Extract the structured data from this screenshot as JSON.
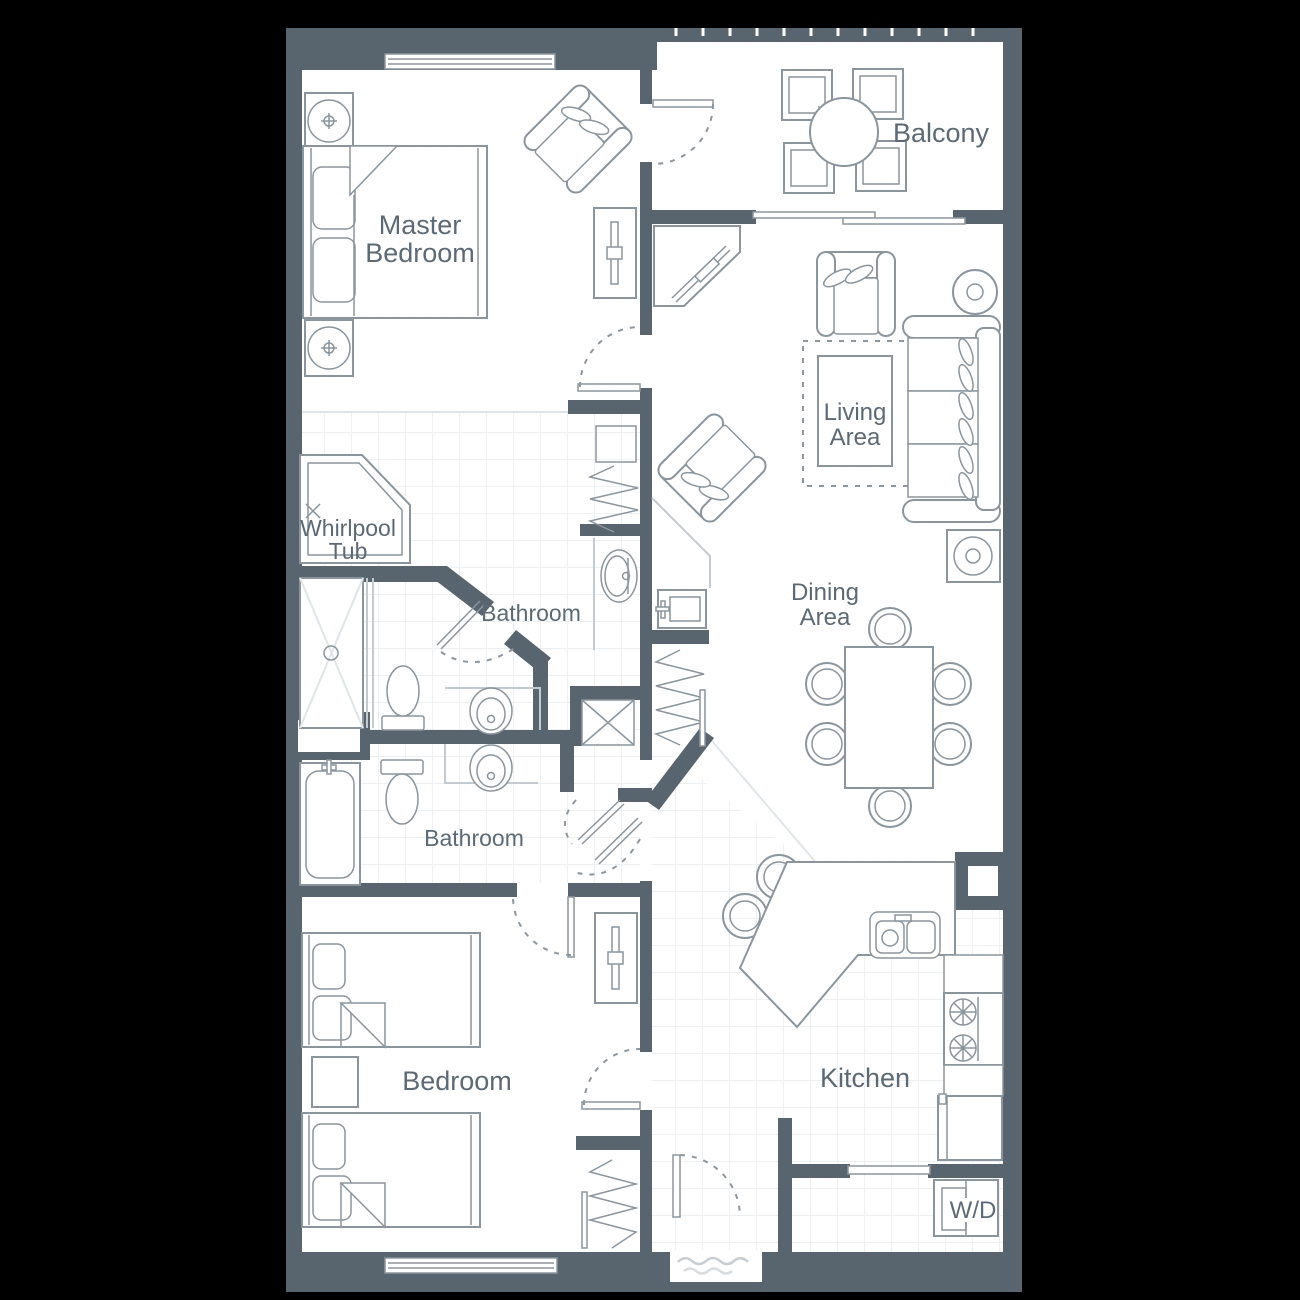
{
  "plan": {
    "rooms": {
      "master_bedroom": {
        "line1": "Master",
        "line2": "Bedroom"
      },
      "balcony": {
        "label": "Balcony"
      },
      "living_area": {
        "line1": "Living",
        "line2": "Area"
      },
      "dining_area": {
        "line1": "Dining",
        "line2": "Area"
      },
      "whirlpool": {
        "line1": "Whirlpool",
        "line2": "Tub"
      },
      "bathroom_master": {
        "label": "Bathroom"
      },
      "bathroom_guest": {
        "label": "Bathroom"
      },
      "bedroom": {
        "label": "Bedroom"
      },
      "kitchen": {
        "label": "Kitchen"
      },
      "laundry": {
        "label": "W/D"
      }
    },
    "colors": {
      "background": "#000000",
      "wall": "#58646e",
      "floor": "#ffffff",
      "furniture_line": "#8b959d",
      "label_text": "#5d6a76",
      "tile_line": "#eef1f3"
    }
  }
}
